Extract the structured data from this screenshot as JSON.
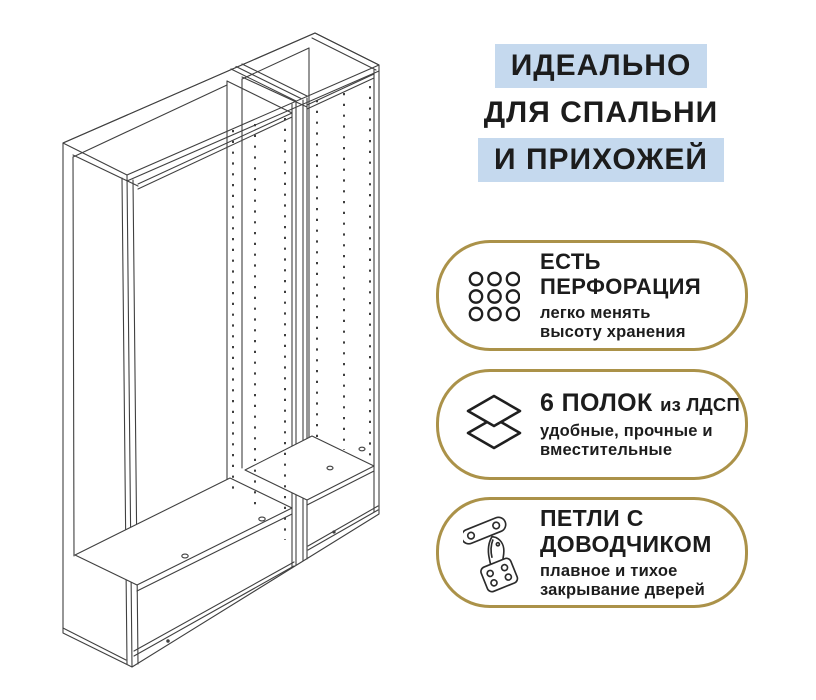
{
  "headline": {
    "line1": "ИДЕАЛЬНО",
    "line2": "ДЛЯ СПАЛЬНИ",
    "line3": "И ПРИХОЖЕЙ"
  },
  "badges": [
    {
      "icon": "perforation-grid-icon",
      "title_line1": "ЕСТЬ",
      "title_line2": "ПЕРФОРАЦИЯ",
      "sub_line1": "легко менять",
      "sub_line2": "высоту хранения"
    },
    {
      "icon": "shelves-layers-icon",
      "title_line1": "6 ПОЛОК",
      "title_suffix": "из ЛДСП",
      "sub_line1": "удобные, прочные и",
      "sub_line2": "вместительные"
    },
    {
      "icon": "hinge-icon",
      "title_line1": "ПЕТЛИ С",
      "title_line2": "ДОВОДЧИКОМ",
      "sub_line1": "плавное и тихое",
      "sub_line2": "закрывание дверей"
    }
  ],
  "colors": {
    "highlight_blue": "#c5d9ee",
    "badge_border_gold": "#ab9249",
    "text": "#1c1c1c",
    "line_art": "#404040"
  }
}
